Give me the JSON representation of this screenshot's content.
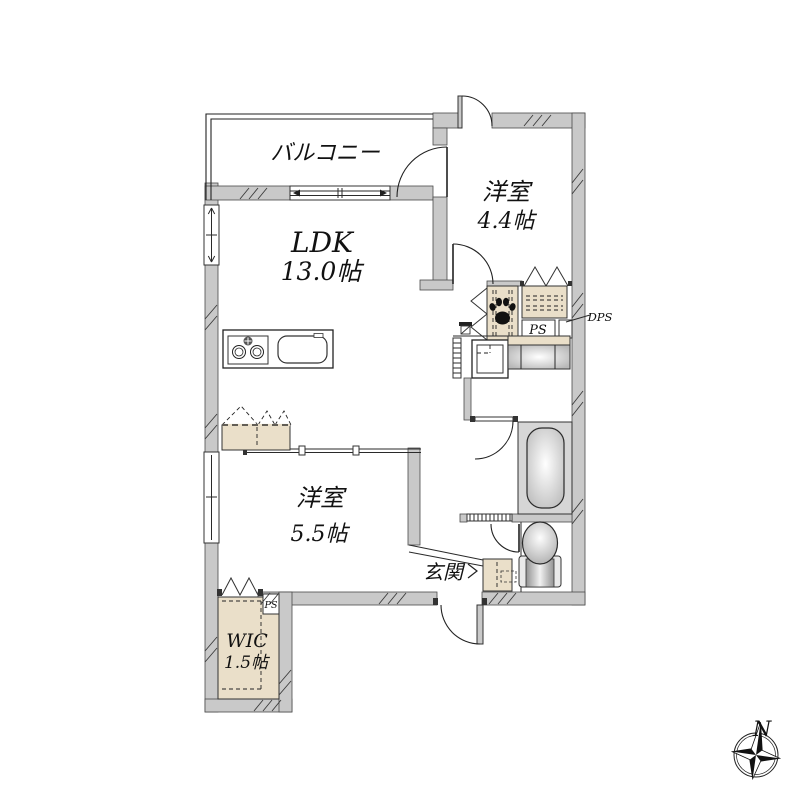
{
  "floor_plan": {
    "rooms": {
      "balcony": {
        "label": "バルコニー"
      },
      "bedroom1": {
        "label": "洋室",
        "size": "4.4帖"
      },
      "ldk": {
        "label": "LDK",
        "size": "13.0帖"
      },
      "bedroom2": {
        "label": "洋室",
        "size": "5.5帖"
      },
      "wic": {
        "label": "WIC",
        "size": "1.5帖"
      },
      "entrance": {
        "label": "玄関"
      }
    },
    "labels": {
      "ps": "PS",
      "dps": "DPS",
      "wic_ps": "PS"
    },
    "compass": {
      "north": "N"
    },
    "colors": {
      "background": "#ffffff",
      "wall_fill": "#c9c9c9",
      "wall_stroke": "#4a4a4a",
      "line": "#222222",
      "closet_fill": "#eadfc9",
      "bath_floor": "#d6d6d6"
    }
  }
}
